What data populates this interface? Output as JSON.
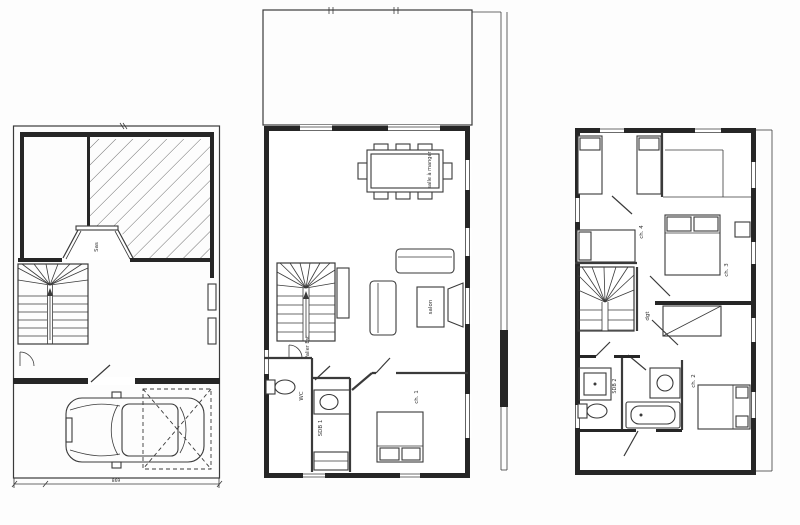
{
  "plans": {
    "ground": {
      "labels": {
        "sas": "Sas"
      },
      "dimensions": {
        "garage_width": "869"
      }
    },
    "main": {
      "labels": {
        "dining_room": "salle à manger",
        "living_room": "salon",
        "stair_landing": "Palier Esc",
        "wc": "WC",
        "bathroom": "SDB 1",
        "bedroom_1": "ch. 1"
      }
    },
    "upper": {
      "labels": {
        "bedroom_4": "ch. 4",
        "bedroom_3": "ch. 3",
        "hallway": "dgt",
        "bathroom_2": "SDB 2",
        "bedroom_2": "ch. 2"
      }
    }
  },
  "colors": {
    "ink": "#3a3a3a",
    "wall": "#262626",
    "paper": "#fdfdfd",
    "hatch": "#6f6f6f"
  }
}
